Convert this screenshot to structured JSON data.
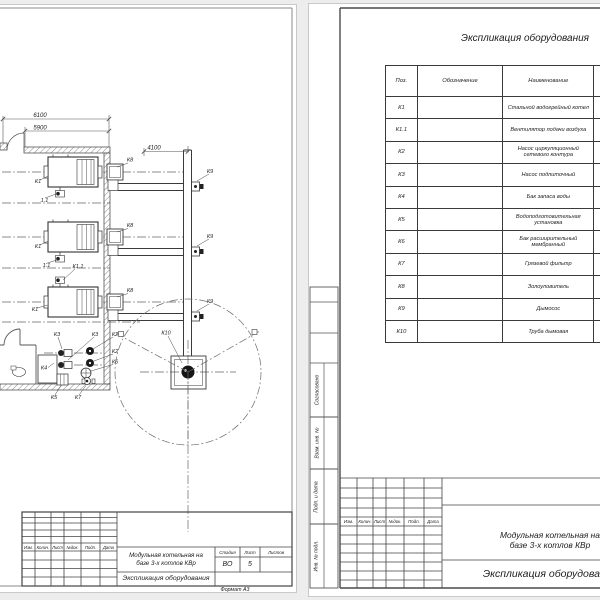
{
  "project": {
    "line1": "Модульная котельная на",
    "line2": "базе 3-х котлов КВр"
  },
  "doc_title": "Экспликация оборудования",
  "left_sheet": {
    "dims": {
      "width_outer": "6100",
      "width_inner": "5900",
      "flue_offset": "4100"
    },
    "labels": {
      "boiler": "К1",
      "boiler_fan": "К1.1",
      "boiler_fan_short": "1.1",
      "pump_network": "К2",
      "pump_makeup": "К3",
      "water_tank": "К4",
      "water_treatment": "К5",
      "expansion_tank": "К6",
      "mud_filter": "К7",
      "ash_catcher": "К8",
      "smoke_exhauster": "К9",
      "chimney": "К10"
    },
    "title_block": {
      "headers": [
        "Изм.",
        "Колич.",
        "Лист",
        "№док.",
        "Подп.",
        "Дата"
      ],
      "stage_label": "Стадия",
      "sheet_label": "Лист",
      "sheets_label": "Листов",
      "stage": "ВО",
      "sheet": "5",
      "sheets": "",
      "format": "Формат А3"
    }
  },
  "right_sheet": {
    "table_title": "Экспликация оборудования",
    "table": {
      "headers": [
        "Поз.",
        "Обозначение",
        "Наименование"
      ],
      "rows": [
        {
          "pos": "К1",
          "name": "Стальной водогрейный котел"
        },
        {
          "pos": "К1.1",
          "name": "Вентилятор подачи воздуха"
        },
        {
          "pos": "К2",
          "name": "Насос циркуляционный сетевого контура"
        },
        {
          "pos": "К3",
          "name": "Насос подпиточный"
        },
        {
          "pos": "К4",
          "name": "Бак запаса воды"
        },
        {
          "pos": "К5",
          "name": "Водоподготовительная установка"
        },
        {
          "pos": "К6",
          "name": "Бак расширительный мембранный"
        },
        {
          "pos": "К7",
          "name": "Грязевой фильтр"
        },
        {
          "pos": "К8",
          "name": "Золоуловитель"
        },
        {
          "pos": "К9",
          "name": "Дымосос"
        },
        {
          "pos": "К10",
          "name": "Труба дымовая"
        }
      ]
    },
    "side_labels": [
      "Согласовано",
      "Взам. инв. №",
      "Подп. и дата",
      "Инв. № подл."
    ],
    "title_block": {
      "headers": [
        "Изм.",
        "Колич.",
        "Лист",
        "№док.",
        "Подп.",
        "Дата"
      ]
    }
  }
}
